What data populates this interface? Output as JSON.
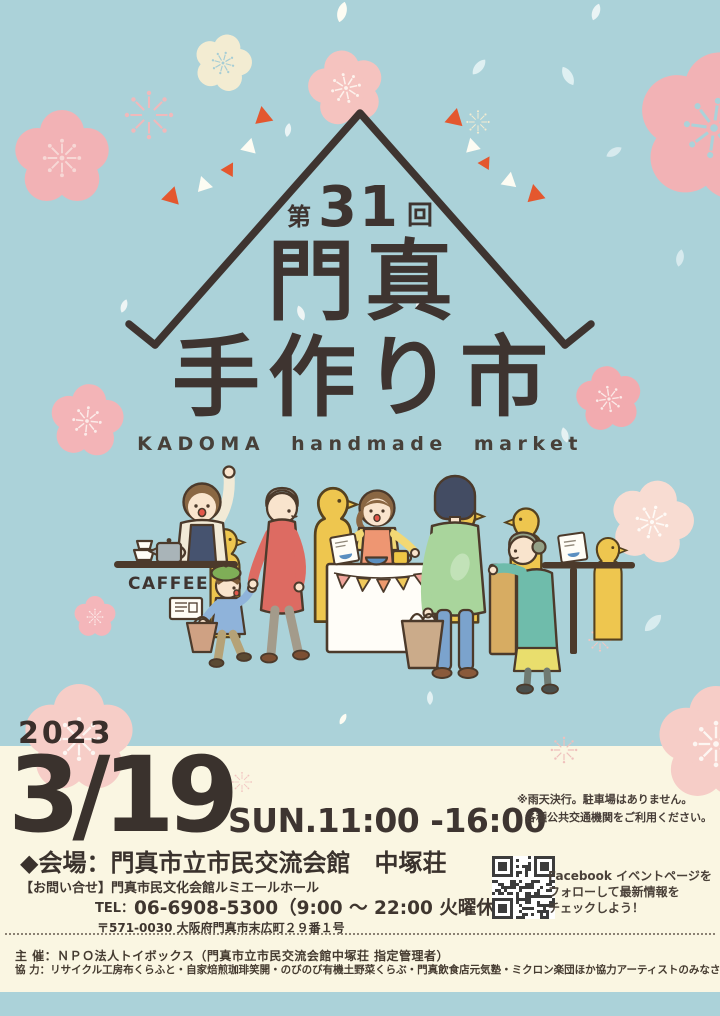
{
  "poster": {
    "badge": {
      "prefix": "第",
      "number": "31",
      "suffix": "回"
    },
    "title": {
      "kanji_top": "門真",
      "kanji_bottom": "手作り市",
      "english": "KADOMA handmade market"
    },
    "illustration": {
      "cafe_sign": "CAFFEE"
    },
    "schedule": {
      "year": "2023",
      "date": "3/19",
      "time": "SUN.11:00 -16:00",
      "note_line1": "※雨天決行。駐車場はありません。",
      "note_line2": "各種公共交通機関をご利用ください。"
    },
    "venue_line": "◆会場：門真市立市民交流会館　中塚荘",
    "inquiry": {
      "label": "【お問い合せ】門真市民文化会館ルミエールホール",
      "tel_label": "TEL：",
      "tel_value": "06-6908-5300（9:00 ～ 22:00 火曜休館）",
      "address": "〒571-0030 大阪府門真市末広町２９番１号"
    },
    "facebook": {
      "line1": "Facebook イベントページを",
      "line2": "フォローして最新情報を",
      "line3": "チェックしよう！"
    },
    "credits": {
      "organizer": "主 催：ＮＰＯ法人トイボックス（門真市立市民交流会館中塚荘 指定管理者）",
      "cooperation": "協 力：リサイクル工房布くらふと・自家焙煎珈琲笑開・のびのび有機土野菜くらぶ・門真飲食店元気塾・ミクロン楽団ほか協力アーティストのみなさん"
    },
    "colors": {
      "background_blue": "#abd2d9",
      "background_cream": "#faf6e2",
      "text_dark": "#3e3430",
      "accent_orange": "#e4572e",
      "flower_pink": "#f2b2b5",
      "flower_pale_pink": "#f6cdc7",
      "flower_cream": "#f3ecd2",
      "petal_blue": "#cfe5ea",
      "crowd_yellow": "#eec64f"
    }
  }
}
